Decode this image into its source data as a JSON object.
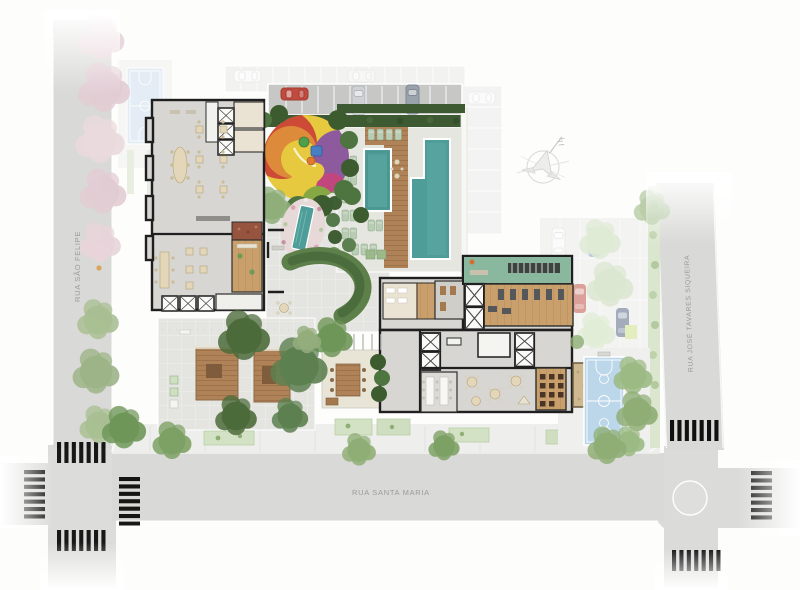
{
  "meta": {
    "type": "architectural-site-plan",
    "width": 800,
    "height": 590
  },
  "streets": {
    "left": {
      "label": "RUA SÃO FELIPE"
    },
    "right": {
      "label": "RUA JOSÉ TAVARES SIQUEIRA"
    },
    "bottom": {
      "label": "RUA SANTA MARIA"
    }
  },
  "icons": {
    "compass": "north-arrow"
  },
  "colors": {
    "street": "#d9d9d7",
    "sidewalk": "#eeeeec",
    "lotPaving": "#e4e4e0",
    "wall": "#1f1f1f",
    "floorGray": "#d7d6d2",
    "floorBeige": "#eae2d3",
    "wood": "#c9a06b",
    "deckWood": "#b08257",
    "poolWater": "#4f9d98",
    "gymGreen": "#8ab89e",
    "courtBlue": "#bcd6ea",
    "courtFadedBlue": "#cfe0ef",
    "hedgeDark": "#3e5a33",
    "hedgeMid": "#5d7f4a",
    "treeGreen": "#7da164",
    "treePink": "#e5d2d8",
    "playYellow": "#e7c93f",
    "playRed": "#cd4a36",
    "playOrange": "#dd8a3a",
    "playPurple": "#8e5a9e",
    "playMagenta": "#c2467e",
    "playGreen": "#86a844",
    "playBlue": "#4a7ec2",
    "carRed": "#c24b3f",
    "carSilver": "#cfd2d4",
    "carGray": "#9aa2ac",
    "labelGray": "#9b9b9b",
    "compassGray": "#d6d6d2"
  }
}
